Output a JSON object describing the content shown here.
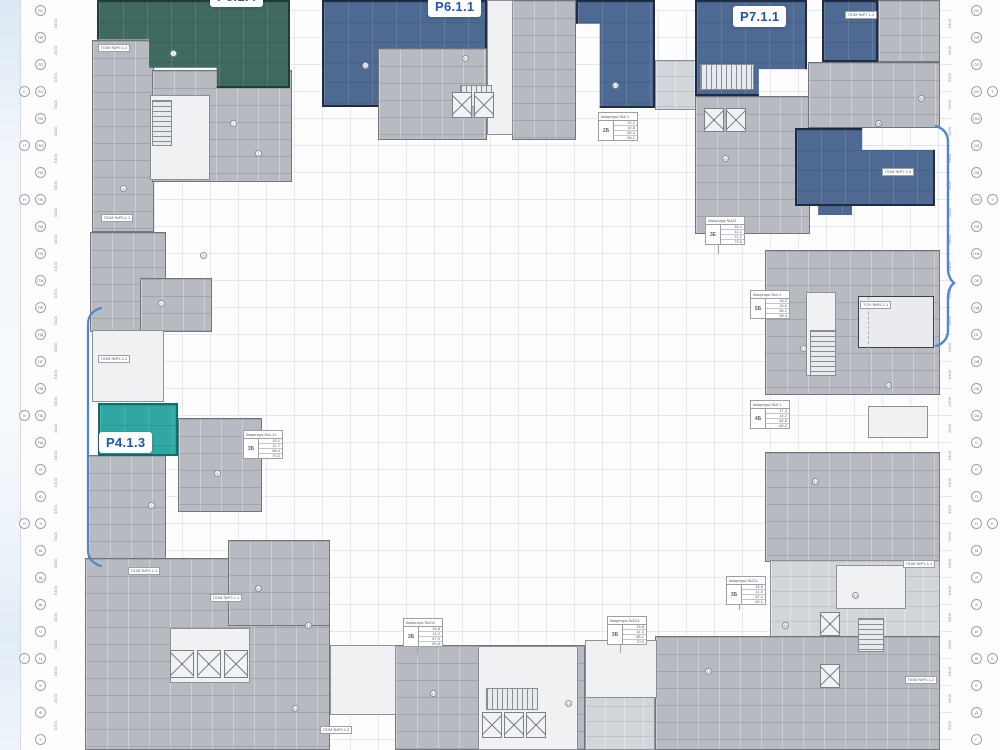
{
  "plan_title": "floor-plan",
  "units": [
    {
      "code": "P5.1.4",
      "color": "#406a60"
    },
    {
      "code": "P6.1.1",
      "color": "#4e6a93"
    },
    {
      "code": "P7.1.1",
      "color": "#4e6a93"
    },
    {
      "code": "P4.1.3",
      "color": "#2fa8a3"
    }
  ],
  "colors": {
    "label_text": "#1b57b2",
    "bracket_blue": "#4c86d4",
    "building_gray": "#b7bac1",
    "building_light": "#d2d5da",
    "grid_line": "#e3e6ec",
    "unit_outline": "#1f2c44"
  },
  "tables": [
    {
      "x": 598,
      "y": 112,
      "title": "Квартира №5.1",
      "badge": "2Б",
      "rows": [
        "14.2",
        "10.8",
        "56.3",
        "58.1"
      ]
    },
    {
      "x": 705,
      "y": 216,
      "title": "Квартира №111",
      "badge": "3Е",
      "rows": [
        "16.4",
        "12.1",
        "71.2",
        "73.5"
      ]
    },
    {
      "x": 750,
      "y": 290,
      "title": "Квартира №4.1",
      "badge": "5Б",
      "rows": [
        "18.2",
        "15.6",
        "96.1",
        "98.4"
      ]
    },
    {
      "x": 750,
      "y": 400,
      "title": "Квартира №9.1",
      "badge": "4Б",
      "rows": [
        "17.3",
        "14.2",
        "84.6",
        "86.2"
      ]
    },
    {
      "x": 243,
      "y": 430,
      "title": "Квартира №4.11",
      "badge": "3Б",
      "rows": [
        "15.1",
        "11.7",
        "68.4",
        "70.2"
      ]
    },
    {
      "x": 403,
      "y": 618,
      "title": "Квартира №212",
      "badge": "3Б",
      "rows": [
        "15.8",
        "11.2",
        "67.9",
        "69.8"
      ]
    },
    {
      "x": 607,
      "y": 616,
      "title": "Квартира №213",
      "badge": "3Б",
      "rows": [
        "15.8",
        "11.3",
        "68.1",
        "70.0"
      ]
    },
    {
      "x": 726,
      "y": 576,
      "title": "Квартира №211",
      "badge": "3Б",
      "rows": [
        "15.6",
        "11.0",
        "67.4",
        "69.1"
      ]
    }
  ],
  "pom_labels": [
    {
      "x": 98,
      "y": 44,
      "text": "ПОМ №Р5.1.2"
    },
    {
      "x": 101,
      "y": 214,
      "text": "ПОМ №Р5.1.1"
    },
    {
      "x": 98,
      "y": 355,
      "text": "ПОМ №Р4.1.2"
    },
    {
      "x": 128,
      "y": 567,
      "text": "ПОМ №Р4.1.1"
    },
    {
      "x": 210,
      "y": 594,
      "text": "ПОМ №Р3.1.1"
    },
    {
      "x": 320,
      "y": 726,
      "text": "ПОМ №Р3.1.2"
    },
    {
      "x": 845,
      "y": 11,
      "text": "ПОМ №Р7.1.2"
    },
    {
      "x": 882,
      "y": 168,
      "text": "ПОМ №Р7.1.5"
    },
    {
      "x": 860,
      "y": 301,
      "text": "ТСН №Р8.1.1"
    },
    {
      "x": 903,
      "y": 560,
      "text": "ПОМ №Р1.1.1"
    },
    {
      "x": 905,
      "y": 676,
      "text": "ПОМ №Р1.1.2"
    }
  ],
  "axes": {
    "left": {
      "x": 40,
      "start_y": 10,
      "step": 27,
      "labels": [
        "ПС",
        "ПР",
        "ПП",
        "ПО",
        "ПН",
        "ПМ",
        "ПЛ",
        "ПК",
        "ПИ",
        "ПЗ",
        "ПЖ",
        "ПЕ",
        "ПД",
        "ПГ",
        "ПВ",
        "ПБ",
        "ПА",
        "Я",
        "Ю",
        "Э",
        "Ы",
        "Щ",
        "Ш",
        "Ч",
        "Ц",
        "Х",
        "Ф",
        "У"
      ]
    },
    "right": {
      "x": 976,
      "start_y": 10,
      "step": 27,
      "labels": [
        "ОС",
        "ОР",
        "ОП",
        "ОН",
        "ОМ",
        "ОЛ",
        "ОК",
        "ОИ",
        "ОЗ",
        "ОЖ",
        "ОЕ",
        "ОД",
        "ОГ",
        "ОВ",
        "ОБ",
        "ОА",
        "С",
        "Р",
        "П",
        "Н",
        "М",
        "Л",
        "К",
        "И",
        "Ж",
        "Е",
        "Д",
        "Г"
      ]
    },
    "left_pairs": [
      {
        "y": 91,
        "label": "С"
      },
      {
        "y": 145,
        "label": "П"
      },
      {
        "y": 199,
        "label": "Н"
      },
      {
        "y": 415,
        "label": "К"
      },
      {
        "y": 523,
        "label": "Б"
      },
      {
        "y": 658,
        "label": "Г"
      }
    ],
    "right_pairs": [
      {
        "y": 91,
        "label": "Т"
      },
      {
        "y": 199,
        "label": "У"
      },
      {
        "y": 523,
        "label": "Е"
      },
      {
        "y": 658,
        "label": "Б"
      }
    ]
  },
  "dimensions": {
    "left_x": 57,
    "right_x": 951,
    "start_y": 23,
    "step": 27,
    "values": [
      "5400",
      "3400",
      "5400",
      "5400",
      "3400",
      "5400",
      "5400",
      "5400",
      "3400",
      "5400",
      "5400",
      "3400",
      "5400",
      "5400",
      "5400",
      "3400",
      "5400",
      "5400",
      "3400",
      "5400",
      "5400",
      "5400",
      "3400",
      "5400",
      "5400",
      "3400",
      "5400"
    ]
  },
  "markers": [
    {
      "x": 170,
      "y": 50,
      "n": "1"
    },
    {
      "x": 230,
      "y": 120,
      "n": "2"
    },
    {
      "x": 255,
      "y": 150,
      "n": "3"
    },
    {
      "x": 120,
      "y": 185,
      "n": "4"
    },
    {
      "x": 200,
      "y": 252,
      "n": "5"
    },
    {
      "x": 158,
      "y": 300,
      "n": "6"
    },
    {
      "x": 112,
      "y": 432,
      "n": "7"
    },
    {
      "x": 214,
      "y": 470,
      "n": "8"
    },
    {
      "x": 148,
      "y": 502,
      "n": "9"
    },
    {
      "x": 255,
      "y": 585,
      "n": "10"
    },
    {
      "x": 305,
      "y": 622,
      "n": "11"
    },
    {
      "x": 430,
      "y": 690,
      "n": "12"
    },
    {
      "x": 565,
      "y": 700,
      "n": "13"
    },
    {
      "x": 705,
      "y": 668,
      "n": "14"
    },
    {
      "x": 782,
      "y": 622,
      "n": "15"
    },
    {
      "x": 852,
      "y": 592,
      "n": "16"
    },
    {
      "x": 800,
      "y": 345,
      "n": "17"
    },
    {
      "x": 885,
      "y": 382,
      "n": "18"
    },
    {
      "x": 812,
      "y": 478,
      "n": "19"
    },
    {
      "x": 722,
      "y": 155,
      "n": "20"
    },
    {
      "x": 612,
      "y": 82,
      "n": "21"
    },
    {
      "x": 362,
      "y": 62,
      "n": "22"
    },
    {
      "x": 462,
      "y": 55,
      "n": "23"
    },
    {
      "x": 292,
      "y": 705,
      "n": "24"
    },
    {
      "x": 875,
      "y": 120,
      "n": "25"
    },
    {
      "x": 918,
      "y": 95,
      "n": "26"
    }
  ]
}
